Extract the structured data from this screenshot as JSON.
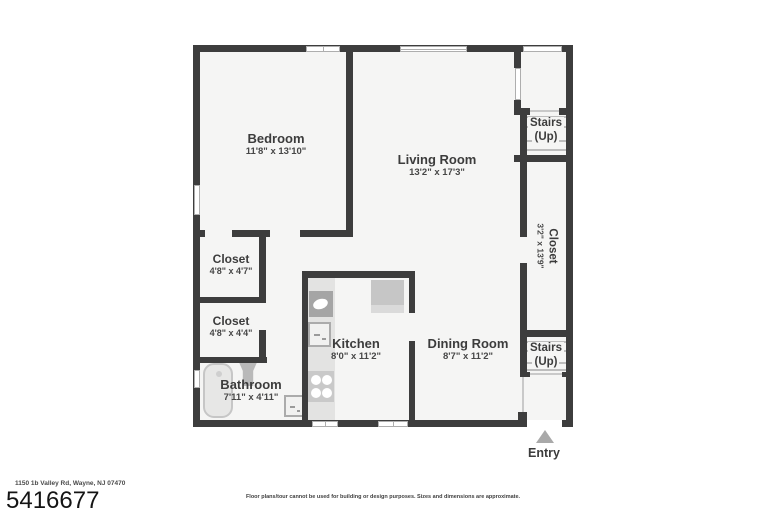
{
  "rooms": {
    "bedroom": {
      "name": "Bedroom",
      "dims": "11'8\" x 13'10\""
    },
    "living": {
      "name": "Living Room",
      "dims": "13'2\" x 17'3\""
    },
    "stairs_top": {
      "name": "Stairs",
      "direction": "(Up)"
    },
    "closet_right": {
      "name": "Closet",
      "dims": "3'2\" x 13'9\""
    },
    "closet_upper": {
      "name": "Closet",
      "dims": "4'8\" x 4'7\""
    },
    "closet_lower": {
      "name": "Closet",
      "dims": "4'8\" x 4'4\""
    },
    "kitchen": {
      "name": "Kitchen",
      "dims": "8'0\" x 11'2\""
    },
    "dining": {
      "name": "Dining Room",
      "dims": "8'7\" x 11'2\""
    },
    "stairs_bottom": {
      "name": "Stairs",
      "direction": "(Up)"
    },
    "bathroom": {
      "name": "Bathroom",
      "dims": "7'11\" x 4'11\""
    },
    "entry": {
      "name": "Entry"
    }
  },
  "footer": {
    "address": "1150 1b Valley Rd, Wayne, NJ 07470",
    "listing_number": "5416677",
    "disclaimer": "Floor plans/tour cannot be used for building or design purposes. Sizes and dimensions are approximate."
  },
  "colors": {
    "wall": "#3d3d3d",
    "room_fill": "#f5f5f4",
    "fixture_gray": "#c7c7c7",
    "fixture_dark": "#a5a5a5",
    "text": "#3c3c3c",
    "background": "#ffffff"
  }
}
